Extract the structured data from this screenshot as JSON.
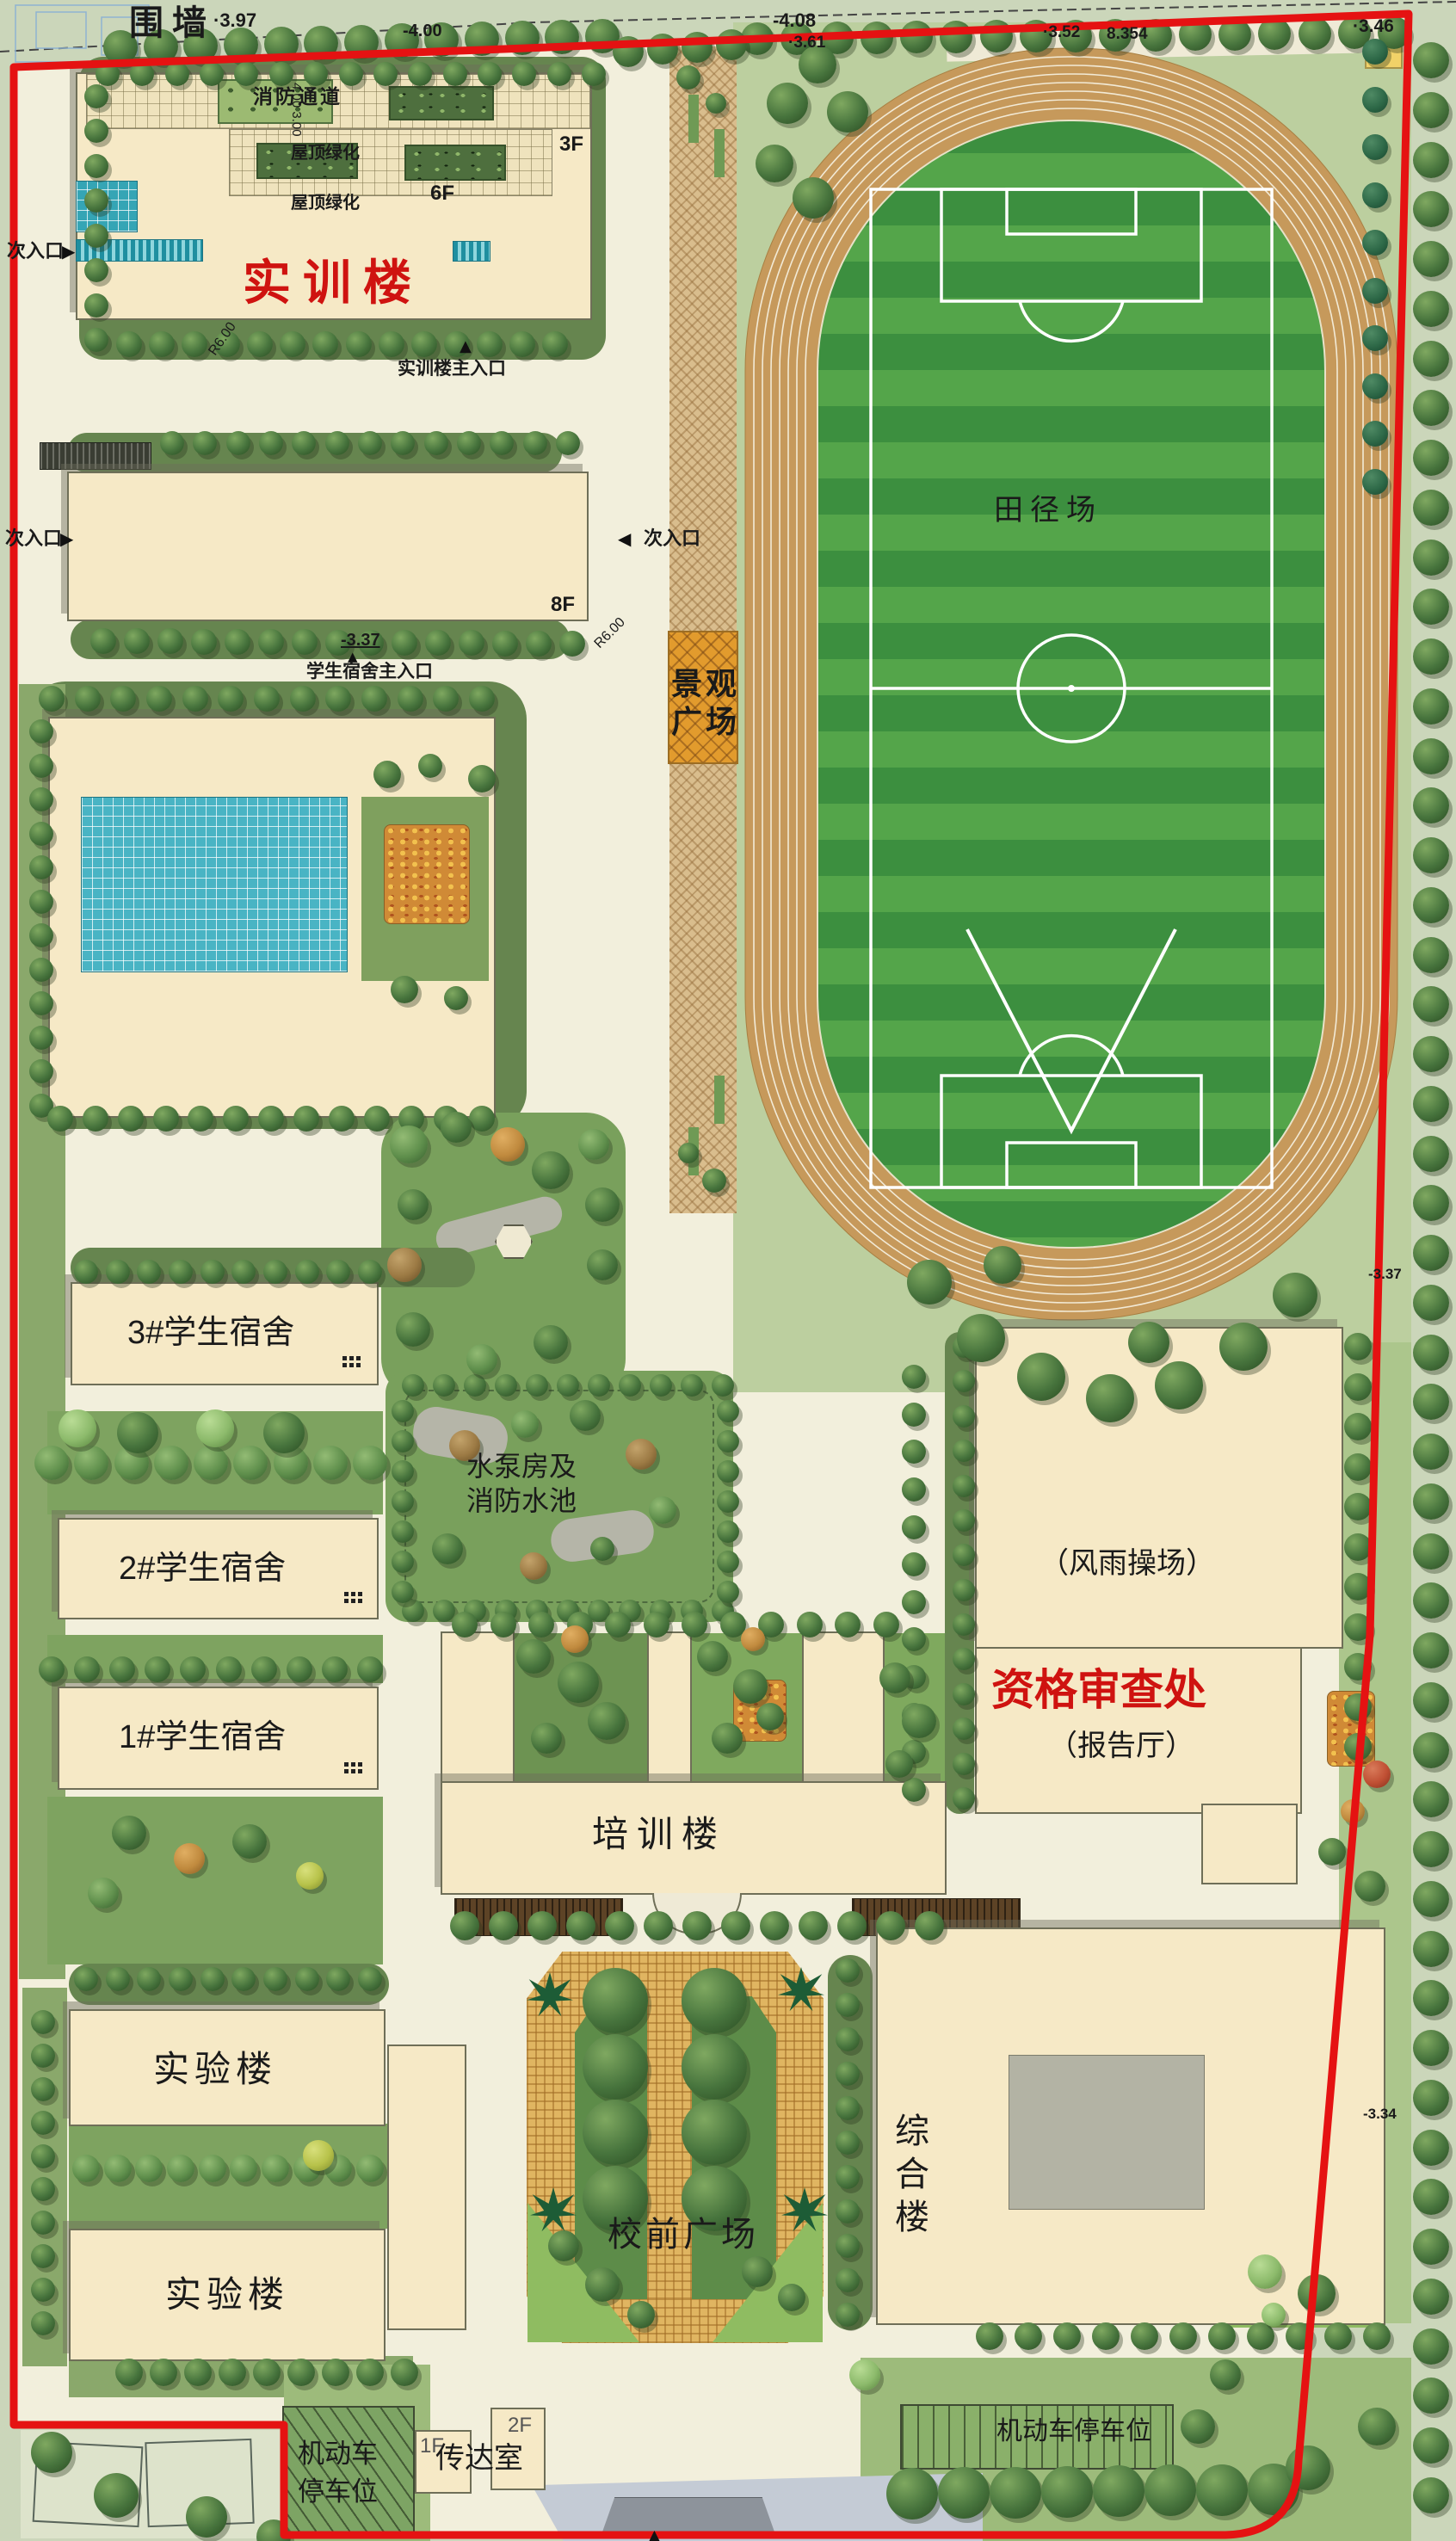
{
  "plan_title_area": {
    "type": "campus-master-plan",
    "boundary_color": "#e51212",
    "accent_red": "#cf1310"
  },
  "labels": {
    "wall": "围墙",
    "elev_397": "·3.97",
    "elev_400": "-4.00",
    "elev_408": "-4.08",
    "elev_361": "·3.61",
    "elev_352": "·3.52",
    "elev_8354": "8.354",
    "elev_346": "·3.46",
    "boundary_elev_337": "-3.37",
    "boundary_elev_334": "-3.34",
    "fire_lane": "消防通道",
    "dim_vertical": "4.00  3.00",
    "roof_green": "屋顶绿化",
    "training_building": "实训楼",
    "f3": "3F",
    "f6": "6F",
    "f8": "8F",
    "f2": "2F",
    "f1": "1F",
    "secondary_entrance": "次入口",
    "training_main_entrance": "实训楼主入口",
    "dorm_main_entrance": "学生宿舍主入口",
    "dorm_entrance_elev": "-3.37",
    "radius": "R6.00",
    "plaza_line1": "景观",
    "plaza_line2": "广场",
    "athletics_field": "田径场",
    "dorm3": "3#学生宿舍",
    "dorm2": "2#学生宿舍",
    "dorm1": "1#学生宿舍",
    "pump_line1": "水泵房及",
    "pump_line2": "消防水池",
    "training_center": "培训楼",
    "gym": "（风雨操场）",
    "qualification_office": "资格审查处",
    "lecture_hall": "（报告厅）",
    "lab": "实验楼",
    "front_plaza": "校前广场",
    "complex_building": "综合楼",
    "parking_line1": "机动车",
    "parking_line2": "停车位",
    "parking_right": "机动车停车位",
    "gatehouse": "传达室"
  },
  "icons": {
    "marker_right": "▶",
    "marker_left": "◀",
    "marker_up": "▲"
  },
  "colors": {
    "site_ground": "#f2efdc",
    "outside_green": "#cbd6ba",
    "building_cream": "#f6e9c6",
    "track_tan": "#c6995b",
    "field_green_dark": "#3c8f3f",
    "field_green_light": "#54a54a",
    "glass_teal": "#35a5b5",
    "plaza_orange": "#e29b2d",
    "hedge_green": "#66854f"
  }
}
